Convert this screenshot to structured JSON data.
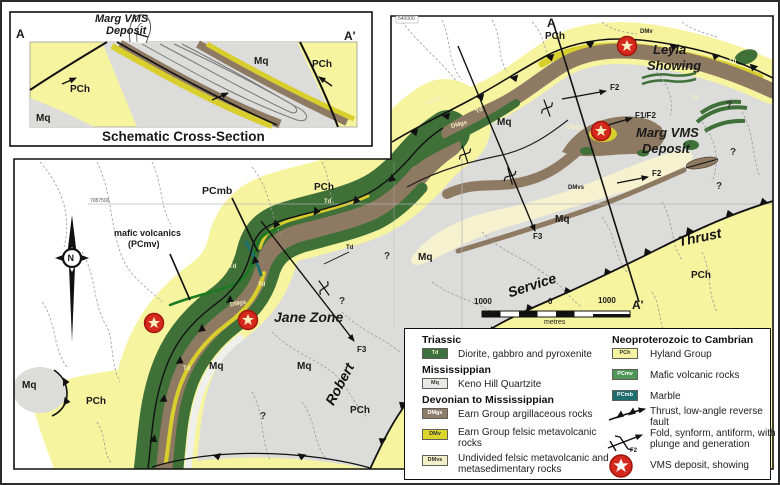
{
  "cross_section": {
    "deposit_label_line1": "Marg VMS",
    "deposit_label_line2": "Deposit",
    "marker_left": "A",
    "marker_right": "A'",
    "pch_left": "PCh",
    "pch_right": "PCh",
    "mq_left": "Mq",
    "mq_right": "Mq",
    "caption": "Schematic Cross-Section"
  },
  "inset_map": {
    "marker_top": "A",
    "marker_bottom": "A'",
    "grid_label": "540000",
    "pch_top": "PCh",
    "pch_lower": "PCh",
    "dmv_small": "DMv",
    "leyla_line1": "Leyla",
    "leyla_line2": "Showing",
    "marg_line1": "Marg VMS",
    "marg_line2": "Deposit",
    "f2_upper": "F2",
    "f1f2": "F1/F2",
    "f2_lower": "F2",
    "f3": "F3",
    "mq_a": "Mq",
    "mq_b": "Mq",
    "mq_c": "Mq",
    "dmgs_a": "DMgs",
    "dmgs_b": "DMgs",
    "dmgs_c": "DMgs",
    "dmvs": "DMvs",
    "td_a": "Td",
    "td_b": "Td",
    "td_c": "Td",
    "q_a": "?",
    "q_b": "?",
    "q_c": "?",
    "q_d": "?"
  },
  "fault_names": {
    "robert": "Robert",
    "service": "Service",
    "thrust": "Thrust"
  },
  "scale_bar": {
    "left": "1000",
    "mid": "0",
    "right": "1000",
    "unit": "metres"
  },
  "main_map": {
    "grid_label": "7087500",
    "pcmb": "PCmb",
    "mafic_line1": "mafic volcanics",
    "mafic_line2": "(PCmv)",
    "pch_a": "PCh",
    "pch_b": "PCh",
    "pch_c": "PCh",
    "td_a": "Td",
    "td_b": "Td",
    "td_c": "Td",
    "td_d": "Td",
    "td_e": "Td",
    "dmgs": "DMgs",
    "jane_zone": "Jane Zone",
    "f3": "F3",
    "mq_a": "Mq",
    "mq_b": "Mq",
    "mq_c": "Mq",
    "q_a": "?",
    "q_b": "?",
    "compass_n": "N"
  },
  "legend": {
    "sections": {
      "triassic": "Triassic",
      "mississippian": "Mississippian",
      "dev_miss": "Devonian to Mississippian",
      "neo_camb": "Neoproterozoic to Cambrian"
    },
    "units": {
      "td": {
        "code": "Td",
        "label": "Diorite, gabbro and pyroxenite"
      },
      "mq": {
        "code": "Mq",
        "label": "Keno Hill Quartzite"
      },
      "dmgs": {
        "code": "DMgs",
        "label": "Earn Group argillaceous rocks"
      },
      "dmv": {
        "code": "DMv",
        "label": "Earn Group felsic metavolcanic rocks"
      },
      "dmvs": {
        "code": "DMvs",
        "label": "Undivided felsic metavolcanic and metasedimentary rocks"
      },
      "pch": {
        "code": "PCh",
        "label": "Hyland Group"
      },
      "pcmv": {
        "code": "PCmv",
        "label": "Mafic volcanic rocks"
      },
      "pcmb": {
        "code": "PCmb",
        "label": "Marble"
      }
    },
    "symbols": {
      "thrust": "Thrust, low-angle reverse fault",
      "fold": "Fold, synform, antiform, with plunge and generation",
      "fold_tag": "F2",
      "vms": "VMS deposit, showing"
    }
  },
  "colors": {
    "pch": "#f7f4a0",
    "mq": "#dcdcda",
    "dmgs": "#8e7a62",
    "dmv": "#d8ce2e",
    "dmvs": "#f6f2cf",
    "td": "#3e7038",
    "pcmv": "#4d9655",
    "pcmb": "#1e6e6e",
    "vms_red": "#d6281c"
  }
}
